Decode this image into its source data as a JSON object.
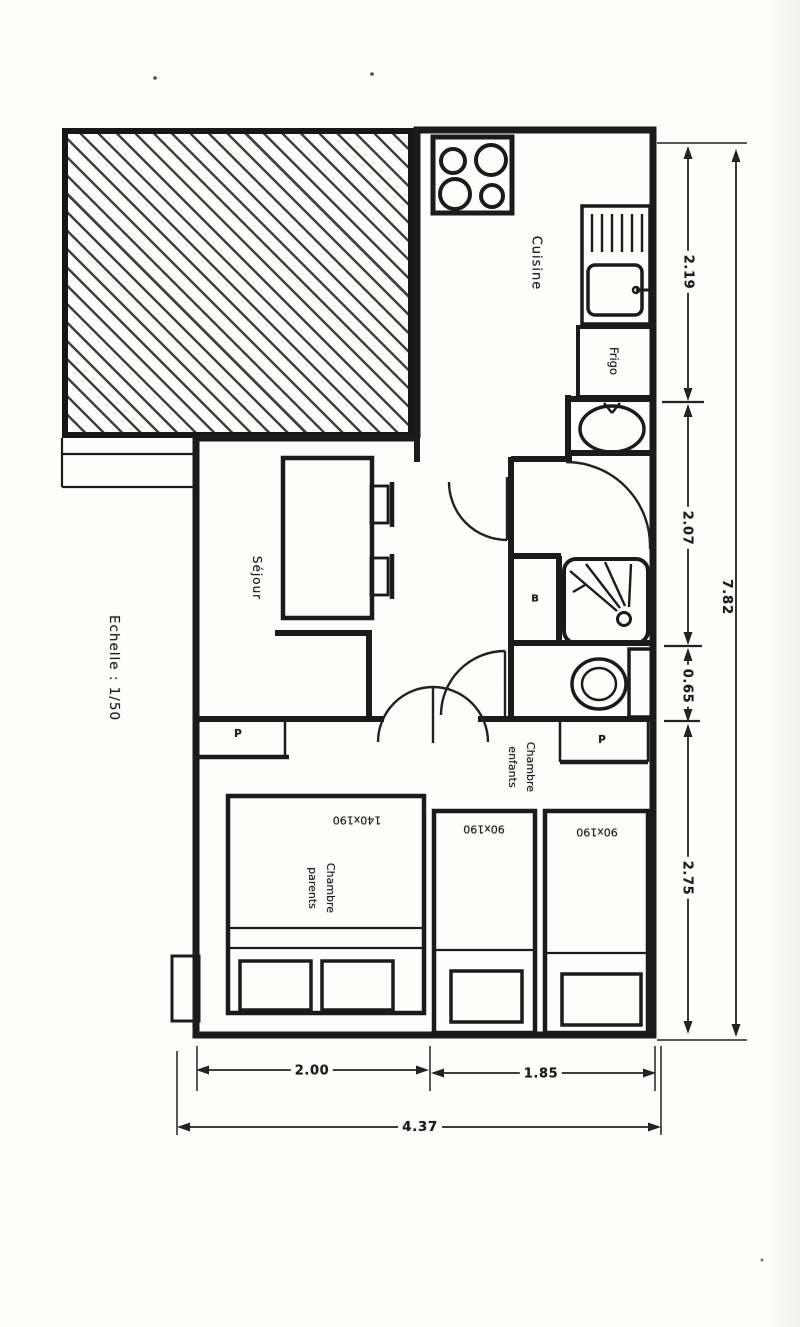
{
  "page": {
    "paper_color": "#fdfdfc",
    "ink_color": "#1b1b1b"
  },
  "plan": {
    "scale_note": "Echelle : 1/50",
    "rooms": {
      "kitchen_label": "Cuisine",
      "fridge_label": "Frigo",
      "living_label": "Séjour",
      "bedroom_parents_line1": "Chambre",
      "bedroom_parents_line2": "parents",
      "bedroom_kids_line1": "Chambre",
      "bedroom_kids_line2": "enfants",
      "closet_left_label": "P",
      "closet_right_label": "P",
      "bath_closet_label": "B"
    },
    "furniture": {
      "double_bed_size": "140x190",
      "single_bed_1_size": "90x190",
      "single_bed_2_size": "90x190"
    },
    "dimensions": {
      "kitchen_depth": "2.19",
      "bath_depth": "2.07",
      "wc_depth": "0.65",
      "bedroom_depth": "2.75",
      "total_depth": "7.82",
      "bedroom_left_width": "2.00",
      "bedroom_right_width": "1.85",
      "total_width": "4.37"
    }
  }
}
